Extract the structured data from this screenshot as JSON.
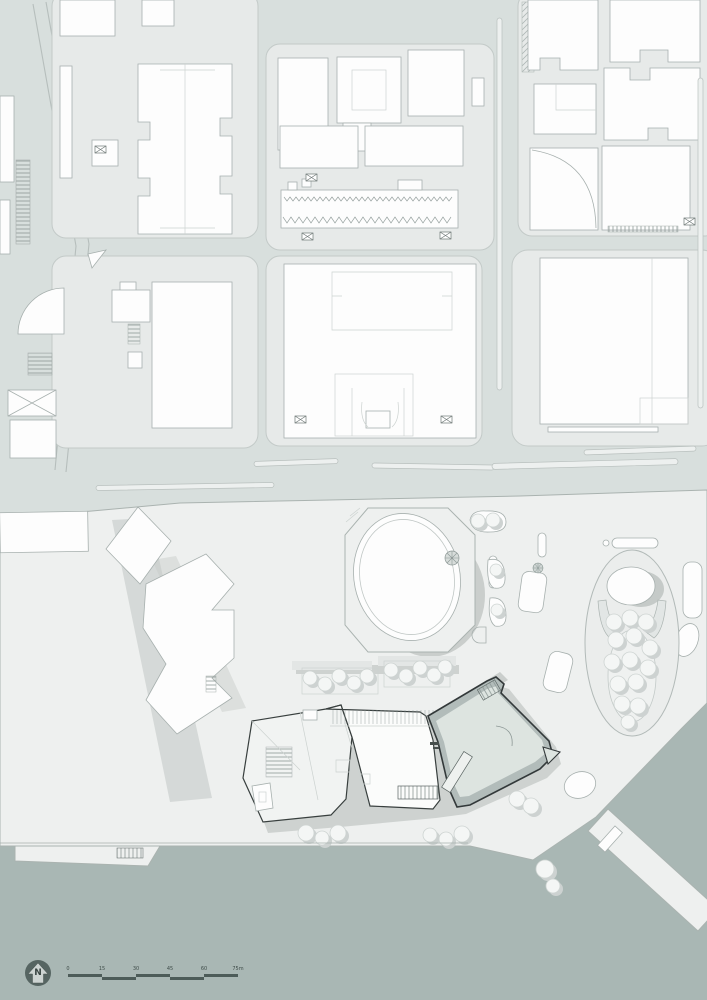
{
  "plan": {
    "type": "architectural-site-plan",
    "landmarks": {
      "main_building": "highlighted-waterfront-building",
      "round_hall": "egg-shaped-hall",
      "garden": "oval-tree-garden",
      "water": "harbor"
    }
  },
  "colors": {
    "street": "#d8dfdd",
    "block": "#e7eae9",
    "building": "#fdfdfd",
    "plaza": "#eef0ef",
    "water": "#a9b7b4",
    "shadow": "#c5cac8",
    "highlight_fill": "#dde4e0",
    "outline_dark": "#33393a",
    "legend": "#4d5c59"
  },
  "north_arrow": {
    "label": "N"
  },
  "scale_bar": {
    "ticks": [
      "0",
      "15",
      "30",
      "45",
      "60",
      "75m"
    ]
  }
}
